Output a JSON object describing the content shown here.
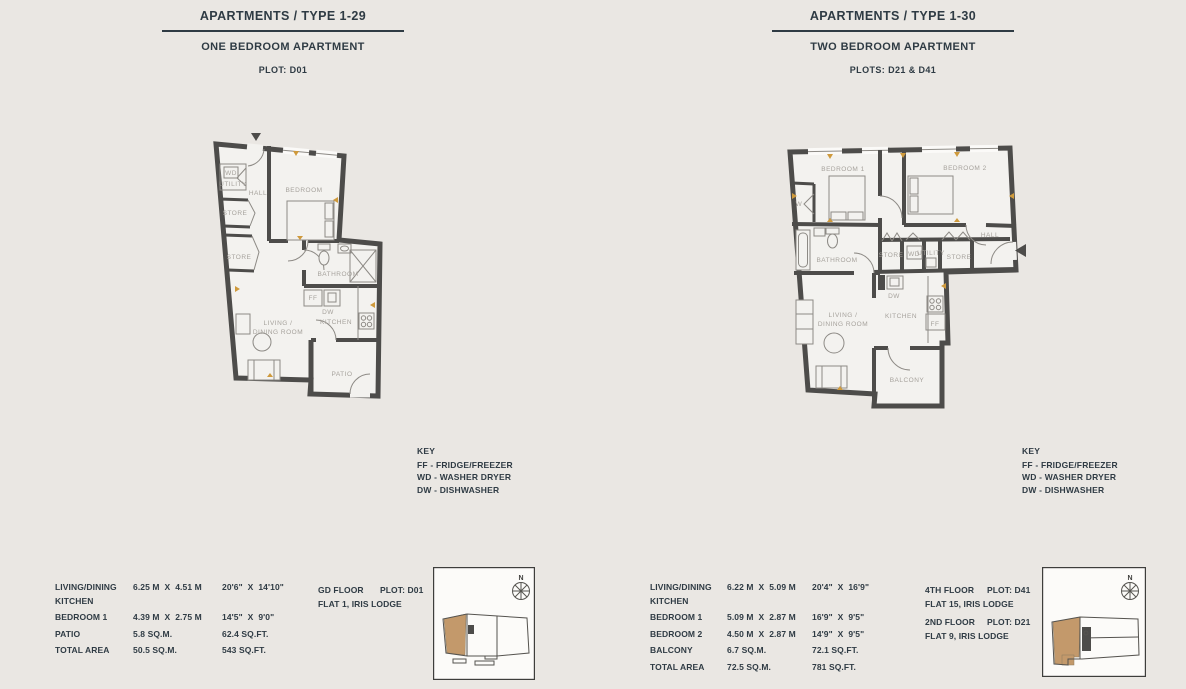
{
  "page": {
    "background_color": "#eae7e3",
    "ink_color": "#2f3b44",
    "wall_color": "#4d4c4a",
    "plan_label_color": "#a6a29c",
    "highlight_tan_color": "#c3996b",
    "dimension_marker_color": "#cf9a3c"
  },
  "left_unit": {
    "title": "APARTMENTS / TYPE 1-29",
    "subtitle": "ONE BEDROOM APARTMENT",
    "plot": "PLOT: D01",
    "rooms": {
      "wd": "WD",
      "utility": "UTILITY",
      "hall": "HALL",
      "store_upper": "STORE",
      "store_lower": "STORE",
      "bedroom": "BEDROOM",
      "bathroom": "BATHROOM",
      "ff": "FF",
      "dw": "DW",
      "kitchen": "KITCHEN",
      "living_line1": "LIVING /",
      "living_line2": "DINING ROOM",
      "patio": "PATIO"
    },
    "key": {
      "heading": "KEY",
      "items": [
        "FF - FRIDGE/FREEZER",
        "WD - WASHER DRYER",
        "DW - DISHWASHER"
      ]
    },
    "spec_rows": [
      {
        "name1": "LIVING/DINING",
        "name2": "KITCHEN",
        "metric": "6.25 M  X  4.51 M",
        "imperial": "20'6\"  X  14'10\""
      },
      {
        "name1": "BEDROOM 1",
        "name2": "",
        "metric": "4.39 M  X  2.75 M",
        "imperial": "14'5\"  X  9'0\""
      },
      {
        "name1": "PATIO",
        "name2": "",
        "metric": "5.8 SQ.M.",
        "imperial": "62.4 SQ.FT."
      },
      {
        "name1": "TOTAL AREA",
        "name2": "",
        "metric": "50.5 SQ.M.",
        "imperial": "543 SQ.FT."
      }
    ],
    "locations": [
      {
        "floor": "GD FLOOR",
        "plot": "PLOT: D01",
        "flat": "FLAT 1, IRIS LODGE"
      }
    ],
    "compass_north": "N"
  },
  "right_unit": {
    "title": "APARTMENTS / TYPE 1-30",
    "subtitle": "TWO BEDROOM APARTMENT",
    "plot": "PLOTS: D21 & D41",
    "rooms": {
      "bedroom1": "BEDROOM 1",
      "bedroom2": "BEDROOM 2",
      "wardrobe": "W",
      "hall": "HALL",
      "bathroom": "BATHROOM",
      "store_left": "STORE",
      "wd": "WD",
      "utility": "UTILITY",
      "store_right": "STORE",
      "dw": "DW",
      "kitchen": "KITCHEN",
      "ff": "FF",
      "living_line1": "LIVING /",
      "living_line2": "DINING ROOM",
      "balcony": "BALCONY"
    },
    "key": {
      "heading": "KEY",
      "items": [
        "FF - FRIDGE/FREEZER",
        "WD - WASHER DRYER",
        "DW - DISHWASHER"
      ]
    },
    "spec_rows": [
      {
        "name1": "LIVING/DINING",
        "name2": "KITCHEN",
        "metric": "6.22 M  X  5.09 M",
        "imperial": "20'4\"  X  16'9\""
      },
      {
        "name1": "BEDROOM 1",
        "name2": "",
        "metric": "5.09 M  X  2.87 M",
        "imperial": "16'9\"  X  9'5\""
      },
      {
        "name1": "BEDROOM 2",
        "name2": "",
        "metric": "4.50 M  X  2.87 M",
        "imperial": "14'9\"  X  9'5\""
      },
      {
        "name1": "BALCONY",
        "name2": "",
        "metric": "6.7 SQ.M.",
        "imperial": "72.1 SQ.FT."
      },
      {
        "name1": "TOTAL AREA",
        "name2": "",
        "metric": "72.5 SQ.M.",
        "imperial": "781 SQ.FT."
      }
    ],
    "locations": [
      {
        "floor": "4TH FLOOR",
        "plot": "PLOT: D41",
        "flat": "FLAT 15, IRIS LODGE"
      },
      {
        "floor": "2ND FLOOR",
        "plot": "PLOT: D21",
        "flat": "FLAT 9, IRIS LODGE"
      }
    ],
    "compass_north": "N"
  }
}
